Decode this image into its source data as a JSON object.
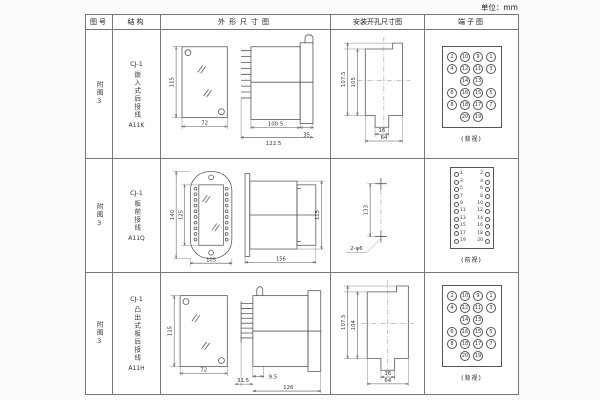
{
  "unit_label": "单位：mm",
  "headers": {
    "fig": "图号",
    "structure": "结构",
    "outline": "外形尺寸图",
    "mounting": "安装开孔尺寸图",
    "terminal": "端子图"
  },
  "rows": [
    {
      "fig": "附图3",
      "model": "CJ-1",
      "type": "嵌入式后接线",
      "code": "A11K",
      "outline": {
        "height": "115",
        "width": "72",
        "depth": "100.5",
        "flange": "35",
        "total_len": "122.5"
      },
      "mounting": {
        "outer_h": "107.5",
        "inner_h": "105",
        "slot_w": "16",
        "hole_span": "64"
      },
      "terminal_label": "(背视)"
    },
    {
      "fig": "附图3",
      "model": "CJ-1",
      "type": "板前接线",
      "code": "A11Q",
      "outline": {
        "outer_h": "140",
        "inner_h": "125",
        "width": "105",
        "length": "156",
        "side_h": "115"
      },
      "mounting": {
        "pitch": "133",
        "holes": "2-φ6"
      },
      "terminal_label": "(前视)"
    },
    {
      "fig": "附图3",
      "model": "CJ-1",
      "type": "凸出式板后接线",
      "code": "A11H",
      "outline": {
        "height": "115",
        "width": "72",
        "pin_len": "31.5",
        "offset": "9.5",
        "length": "126"
      },
      "mounting": {
        "outer_h": "107.5",
        "inner_h": "104",
        "slot_w": "16",
        "hole_span": "64"
      },
      "terminal_label": "(背视)"
    }
  ],
  "terminals": {
    "back_grid": [
      [
        "2",
        "10",
        "9",
        "1"
      ],
      [
        "4",
        "12",
        "11",
        "3"
      ],
      [
        "",
        "14",
        "13",
        ""
      ],
      [
        "6",
        "16",
        "15",
        "5"
      ],
      [
        "8",
        "18",
        "17",
        "7"
      ],
      [
        "",
        "20",
        "19",
        ""
      ]
    ],
    "front_left": [
      "1",
      "3",
      "5",
      "7",
      "9",
      "11",
      "13",
      "15",
      "17",
      "19"
    ],
    "front_right": [
      "2",
      "4",
      "6",
      "8",
      "10",
      "12",
      "14",
      "16",
      "18",
      "20"
    ]
  }
}
